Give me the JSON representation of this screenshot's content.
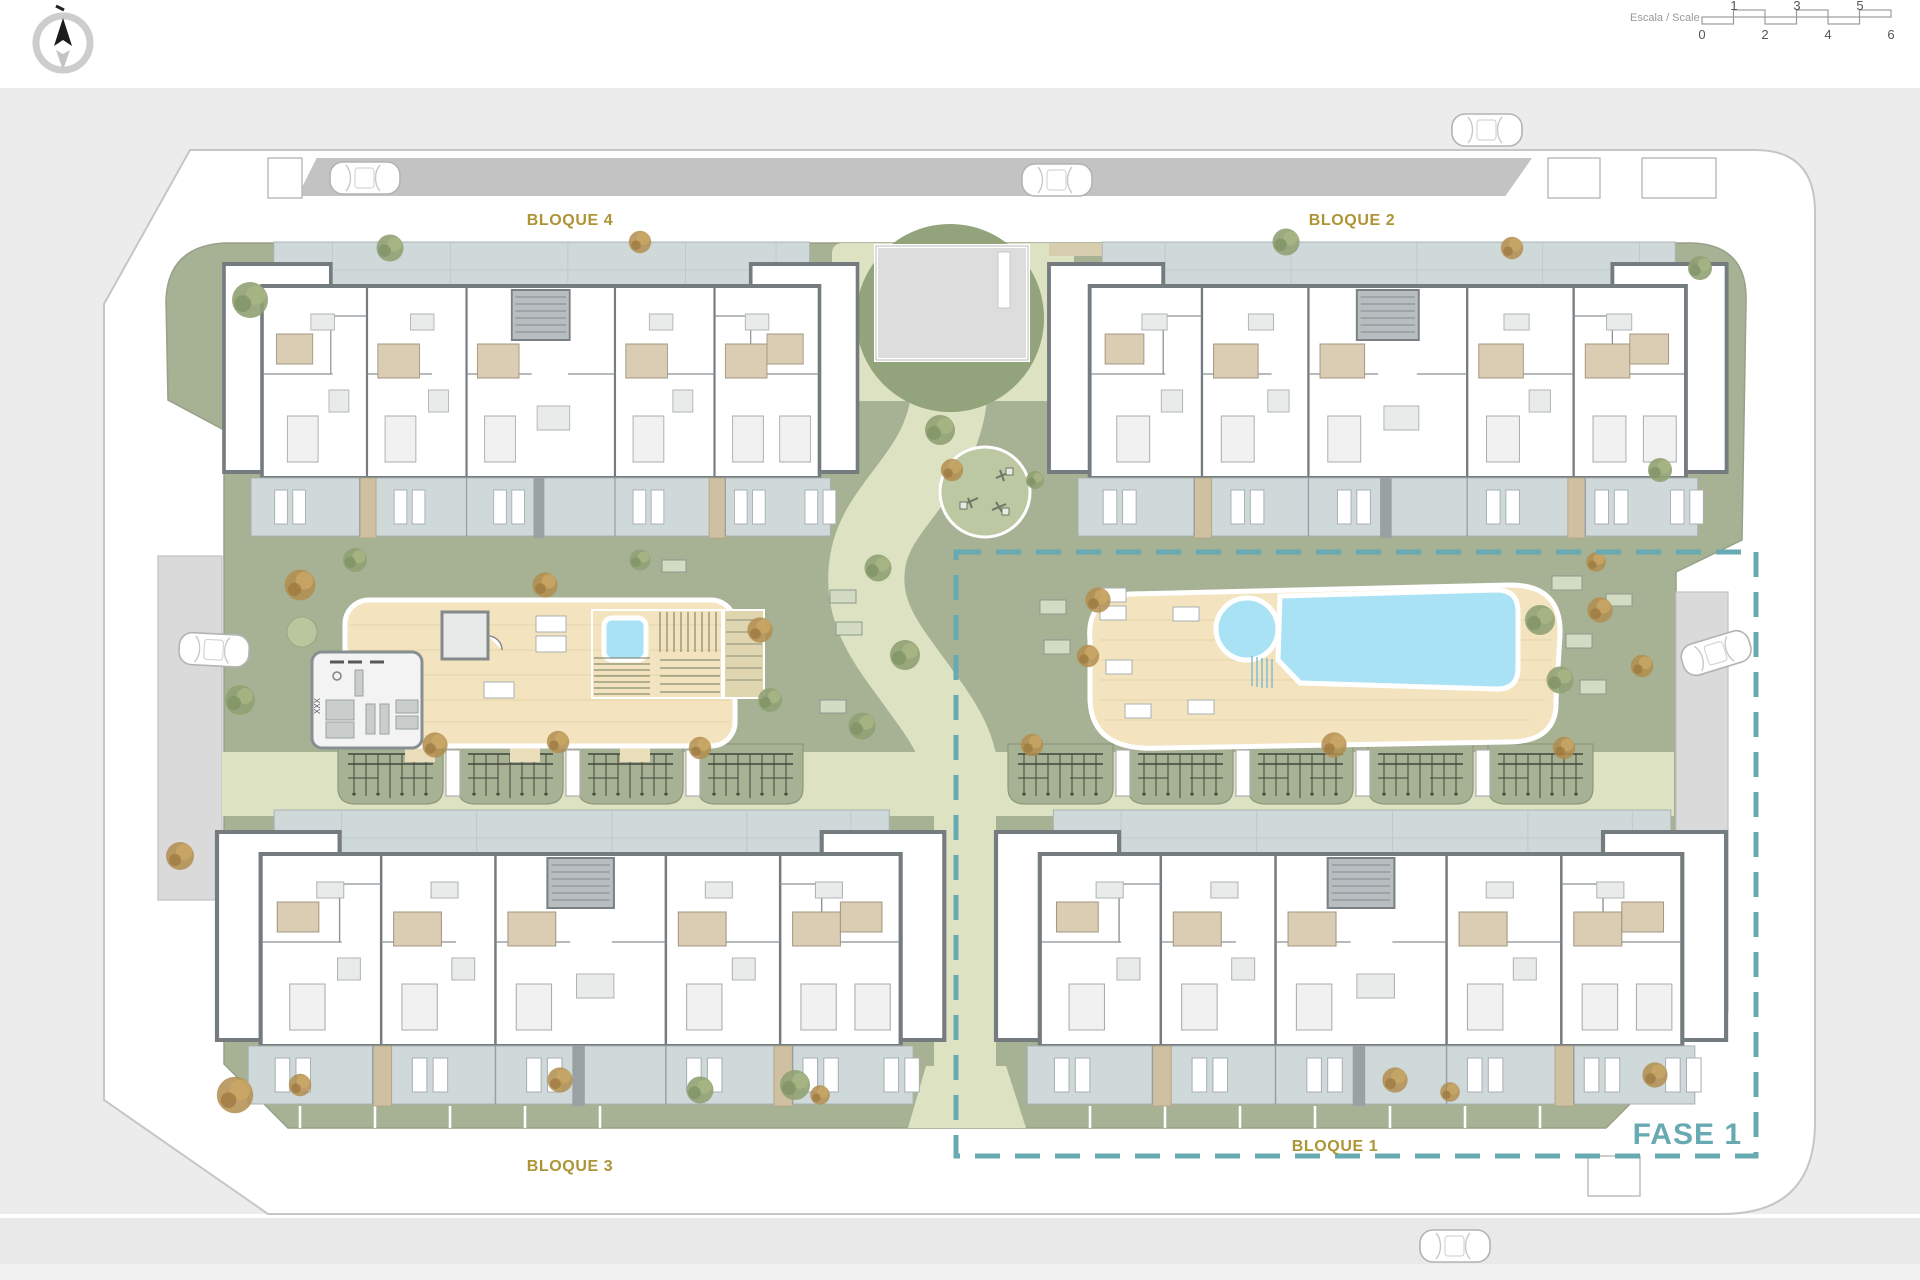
{
  "header": {
    "compass": {
      "icon": "compass-north-icon"
    },
    "scale": {
      "label": "Escala / Scale",
      "top_ticks": [
        "1",
        "3",
        "5"
      ],
      "bottom_ticks": [
        "0",
        "2",
        "4",
        "6"
      ]
    }
  },
  "plan": {
    "blocks": [
      {
        "id": "bloque-4",
        "label": "BLOQUE 4"
      },
      {
        "id": "bloque-2",
        "label": "BLOQUE 2"
      },
      {
        "id": "bloque-3",
        "label": "BLOQUE 3"
      },
      {
        "id": "bloque-1",
        "label": "BLOQUE 1"
      }
    ],
    "phase": {
      "label": "FASE 1"
    }
  },
  "colors": {
    "label-gold": "#ad9434",
    "phase-teal": "#68aab2",
    "site-green": "#a7b294",
    "dark-green": "#93a37c",
    "path-light": "#dde3c2",
    "deck-wood": "#f3e3bf",
    "pool-blue": "#a9e2f5",
    "terrace-grey": "#cfd9da",
    "road-grey": "#c3c3c3",
    "surround-grey": "#ececec",
    "wall-grey": "#757c80"
  }
}
